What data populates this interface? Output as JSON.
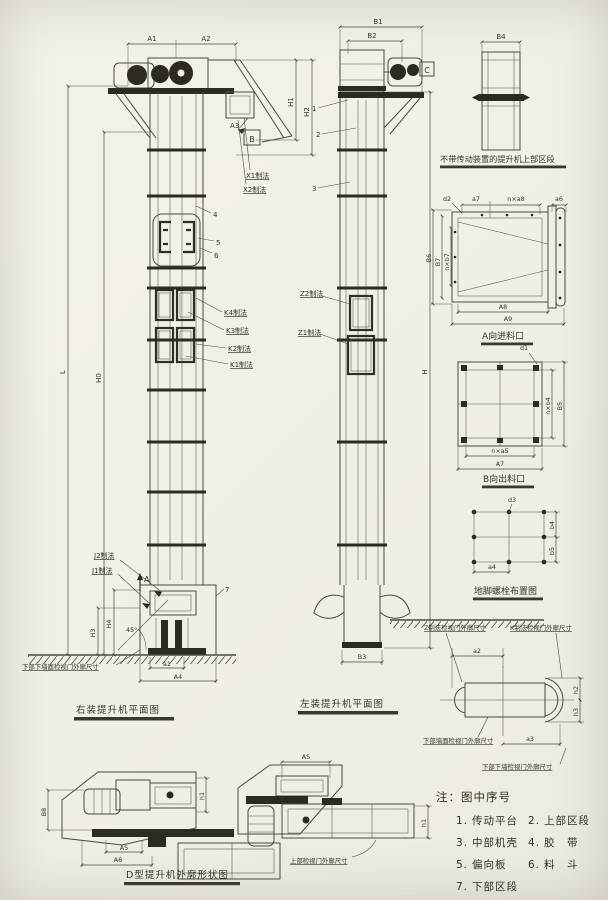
{
  "palette": {
    "paper": "#f1efe7",
    "ink": "#4b4942",
    "dark": "#2c2a22"
  },
  "right_view": {
    "caption": "右装提升机平面图",
    "dim_a1": "A1",
    "dim_a2": "A2",
    "dim_a3": "A3",
    "dim_h1": "H1",
    "dim_h2": "H2",
    "dim_l": "L",
    "dim_h0": "H0",
    "dim_h3": "H3",
    "dim_h4": "H4",
    "dim_a1s": "a1",
    "dim_a4": "A4",
    "sec_b": "B",
    "sec_a": "A",
    "angle": "45°",
    "lbl_x1": "X1制法",
    "lbl_x2": "X2制法",
    "lbl_k4": "K4制法",
    "lbl_k3": "K3制法",
    "lbl_k2": "K2制法",
    "lbl_k1": "K1制法",
    "lbl_j2": "J2制法",
    "lbl_j1": "J1制法",
    "part4": "4",
    "part5": "5",
    "part6": "6",
    "part7": "7",
    "lbl_lower_door": "下部下墙面检视门外廓尺寸"
  },
  "left_view": {
    "caption": "左装提升机平面图",
    "dim_b1": "B1",
    "dim_b2": "B2",
    "dim_b3": "B3",
    "dim_h": "H",
    "sec_c": "C",
    "part1": "1",
    "part2": "2",
    "part3": "3",
    "lbl_z2": "Z2制法",
    "lbl_z1": "Z1制法"
  },
  "upper_section": {
    "caption": "不带传动装置的提升机上部区段",
    "dim_b4": "B4"
  },
  "inlet_view": {
    "caption": "A向进料口",
    "dim_d2": "d2",
    "dim_a7": "a7",
    "dim_na8": "n×a8",
    "dim_a6": "a6",
    "dim_b6": "B6",
    "dim_b7": "B7",
    "dim_nb7": "n×b7",
    "dim_a8": "A8",
    "dim_a9": "A9"
  },
  "outlet_view": {
    "caption": "B向出料口",
    "dim_d1": "d1",
    "dim_nb4": "n×b4",
    "dim_b5": "B5",
    "dim_na5": "n×a5",
    "dim_a7": "A7"
  },
  "anchor_view": {
    "caption": "地脚螺栓布置图",
    "dim_d3": "d3",
    "dim_b4": "b4",
    "dim_b5": "b5",
    "dim_a4": "a4"
  },
  "door_detail": {
    "lbl_z": "Z制法检视门外廓尺寸",
    "lbl_k": "K制法检视门外廓尺寸",
    "lbl_lower_wall": "下部墙面检视门外廓尺寸",
    "lbl_lower_bottom": "下部下墙检视门外廓尺寸",
    "dim_a2": "a2",
    "dim_a3": "a3",
    "dim_h2": "h2",
    "dim_h3": "h3"
  },
  "outline_view": {
    "caption": "D型提升机外廓形状图",
    "lbl_upper_door": "上部检视门外廓尺寸",
    "dim_b8": "B8",
    "dim_a5": "A5",
    "dim_a6": "A6",
    "dim_a5_top": "A5",
    "dim_h1": "h1"
  },
  "notes": {
    "title": "注：图中序号",
    "items": [
      {
        "no": "1.",
        "label": "传动平台"
      },
      {
        "no": "2.",
        "label": "上部区段"
      },
      {
        "no": "3.",
        "label": "中部机壳"
      },
      {
        "no": "4.",
        "label": "胶　带"
      },
      {
        "no": "5.",
        "label": "偏向板"
      },
      {
        "no": "6.",
        "label": "料　斗"
      },
      {
        "no": "7.",
        "label": "下部区段"
      }
    ]
  }
}
